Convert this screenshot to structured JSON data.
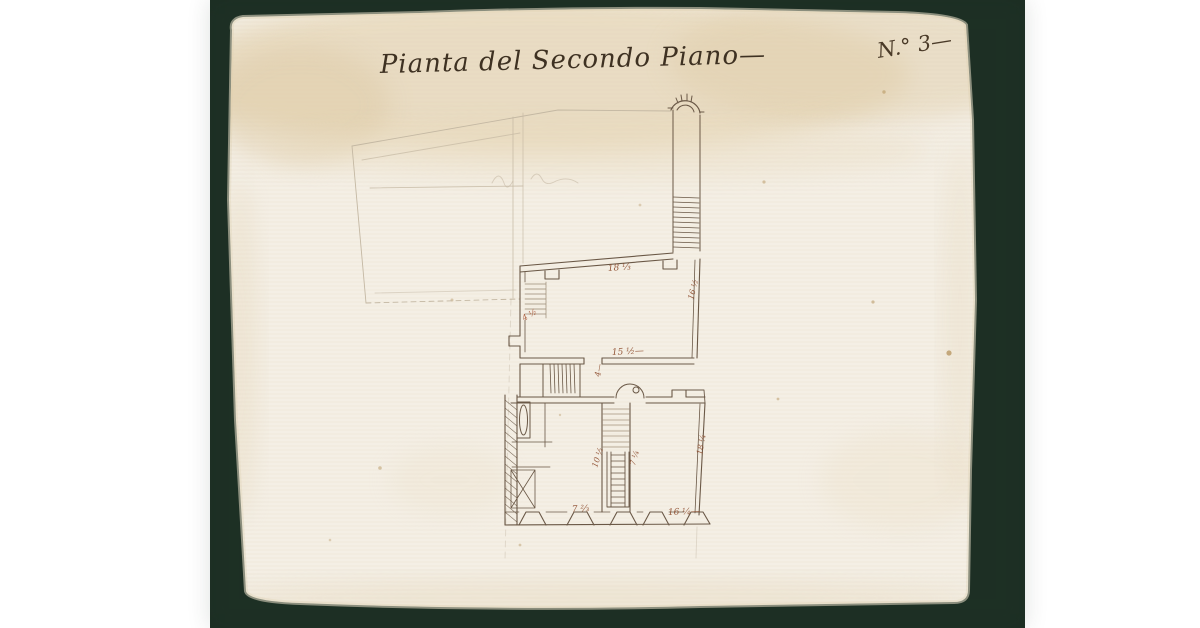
{
  "page": {
    "description": "Photograph of an 18th-century Italian manuscript floor plan on a dark green mat",
    "colors": {
      "letterbox": "#ffffff",
      "mat": "#1c2e23",
      "paper": "#f4efe5",
      "paper_aged_band": "#e4d3b3",
      "ink": "#6a5846",
      "pencil": "#c4b8a3",
      "measure_ink": "#8d4c2c"
    }
  },
  "drawing": {
    "title": "Pianta del Secondo Piano—",
    "sheet_number": "N.° 3—",
    "annotations": {
      "top_wall": "18 ⅓",
      "mid_wall": "15 ½—",
      "door_small": "4—",
      "left_stair": "4 ½",
      "main_right_wall": "16 ½",
      "shaft_left": "10 ½",
      "shaft_right": "7 ¼",
      "lower_right_wall": "18 ¼",
      "bottom_right": "16 ¼—",
      "bottom_left": "7 ⅔"
    }
  }
}
